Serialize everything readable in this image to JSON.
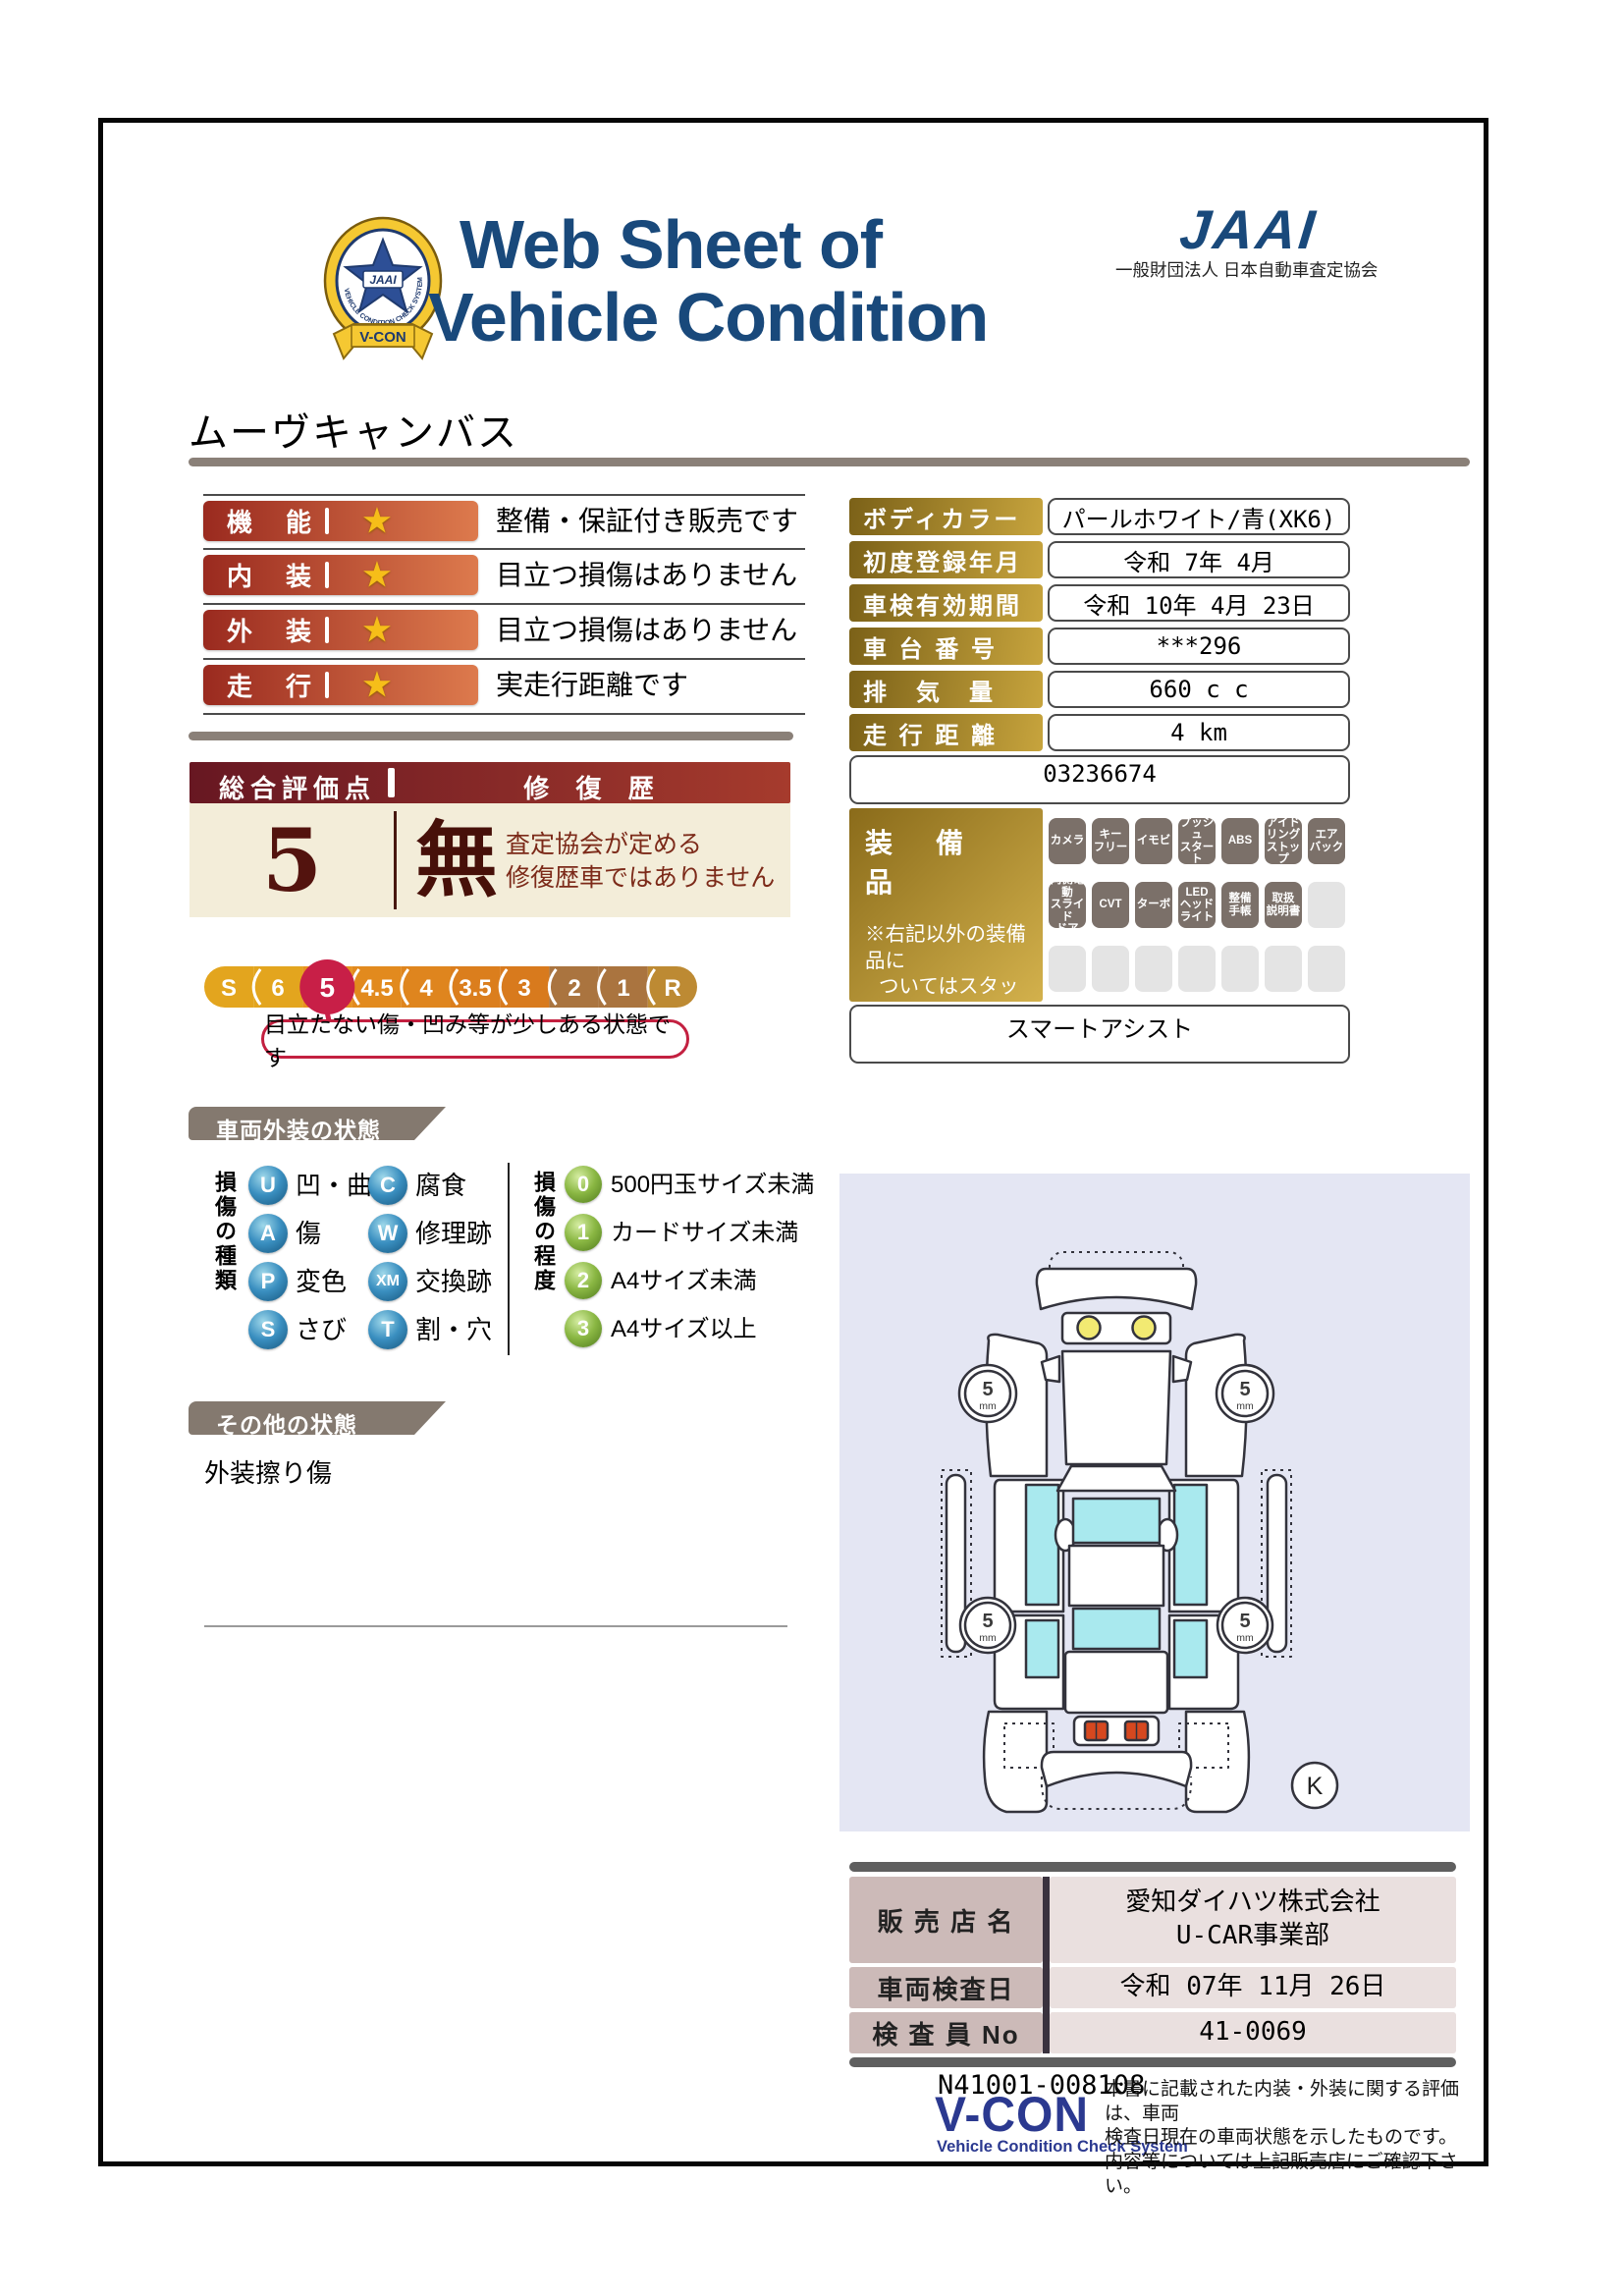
{
  "theme": {
    "title_blue": "#19497b",
    "rating_red": "#9a2a1f",
    "rating_orange": "#dd7a4d",
    "star_gold": "#f6be19",
    "gold_dark": "#7b6118",
    "gold_light": "#c7a43d",
    "maroon_header": "#671722",
    "beige": "#f3edd9",
    "scale_gold": "#e3a51e",
    "scale_selected": "#c81f47",
    "badge_gray": "#7b7069",
    "panel_lavender": "#e4e6f3",
    "glass_cyan": "#a9e9ee",
    "vcon_blue": "#2b3990"
  },
  "header": {
    "title_line1": "Web Sheet of",
    "title_line2": "Vehicle Condition",
    "jaai_logo_text": "JAAI",
    "jaai_org": "一般財団法人 日本自動車査定協会",
    "badge": {
      "vcon": "V-CON",
      "jaai": "JAAI",
      "ring_text": "VEHICLE CONDITION CHECK SYSTEM"
    }
  },
  "vehicle_name": "ムーヴキャンバス",
  "star_char": "★",
  "ratings": [
    {
      "label": "機　能",
      "comment": "整備・保証付き販売です"
    },
    {
      "label": "内　装",
      "comment": "目立つ損傷はありません"
    },
    {
      "label": "外　装",
      "comment": "目立つ損傷はありません"
    },
    {
      "label": "走　行",
      "comment": "実走行距離です"
    }
  ],
  "details": [
    {
      "label": "ボディカラー",
      "value": "パールホワイト/青(XK6)"
    },
    {
      "label": "初度登録年月",
      "value": "令和 7年 4月"
    },
    {
      "label": "車検有効期間",
      "value": "令和 10年 4月 23日"
    },
    {
      "label": "車 台 番 号",
      "value": "***296"
    },
    {
      "label": "排　気　量",
      "value": "660 c c"
    },
    {
      "label": "走 行 距 離",
      "value": "4 km"
    }
  ],
  "reference_number": "03236674",
  "overall": {
    "score_label": "総合評価点",
    "score": "5",
    "repair_label": "修 復 歴",
    "repair_value": "無",
    "repair_note_line1": "査定協会が定める",
    "repair_note_line2": "修復歴車ではありません"
  },
  "scale": {
    "items": [
      "S",
      "6",
      "5",
      "4.5",
      "4",
      "3.5",
      "3",
      "2",
      "1",
      "R"
    ],
    "selected": "5",
    "bubble_text": "目立たない傷・凹み等が少しある状態です"
  },
  "equipment": {
    "label": "装　備　品",
    "note_line1": "※右記以外の装備品に",
    "note_line2": "ついてはスタッフに",
    "note_line3": "お尋ねください。",
    "rows": [
      [
        "カメラ",
        "キー\nフリー",
        "イモビ",
        "プッシュ\nスタート",
        "ABS",
        "アイド\nリング\nストップ",
        "エア\nバック"
      ],
      [
        "両側電動\nスライド\nドア",
        "CVT",
        "ターボ",
        "LED\nヘッド\nライト",
        "整備\n手帳",
        "取扱\n説明書",
        ""
      ],
      [
        "",
        "",
        "",
        "",
        "",
        "",
        ""
      ]
    ],
    "smart_assist": "スマートアシスト"
  },
  "exterior_section": {
    "header": "車両外装の状態",
    "types_title": "損傷の種類",
    "types": [
      {
        "code": "U",
        "label": "凹・曲"
      },
      {
        "code": "A",
        "label": "傷"
      },
      {
        "code": "P",
        "label": "変色"
      },
      {
        "code": "S",
        "label": "さび"
      },
      {
        "code": "C",
        "label": "腐食"
      },
      {
        "code": "W",
        "label": "修理跡"
      },
      {
        "code": "XM",
        "label": "交換跡"
      },
      {
        "code": "T",
        "label": "割・穴"
      }
    ],
    "grades_title": "損傷の程度",
    "grades": [
      {
        "code": "0",
        "label": "500円玉サイズ未満"
      },
      {
        "code": "1",
        "label": "カードサイズ未満"
      },
      {
        "code": "2",
        "label": "A4サイズ未満"
      },
      {
        "code": "3",
        "label": "A4サイズ以上"
      }
    ]
  },
  "other_section": {
    "header": "その他の状態",
    "note": "外装擦り傷"
  },
  "diagram": {
    "tread_value": "5",
    "tread_unit": "mm",
    "marker": "K"
  },
  "dealer": {
    "rows": [
      {
        "label": "販 売 店 名",
        "value": "愛知ダイハツ株式会社\nU-CAR事業部"
      },
      {
        "label": "車両検査日",
        "value": "令和 07年 11月 26日"
      },
      {
        "label": "検 査 員 No",
        "value": "41-0069"
      }
    ]
  },
  "footer": {
    "doc_number": "N41001-008108",
    "vcon_logo": "V-CON",
    "vcon_sub": "Vehicle Condition Check System",
    "disclaimer": "本書に記載された内装・外装に関する評価は、車両\n検査日現在の車両状態を示したものです。\n内容等については上記販売店にご確認下さい。"
  }
}
